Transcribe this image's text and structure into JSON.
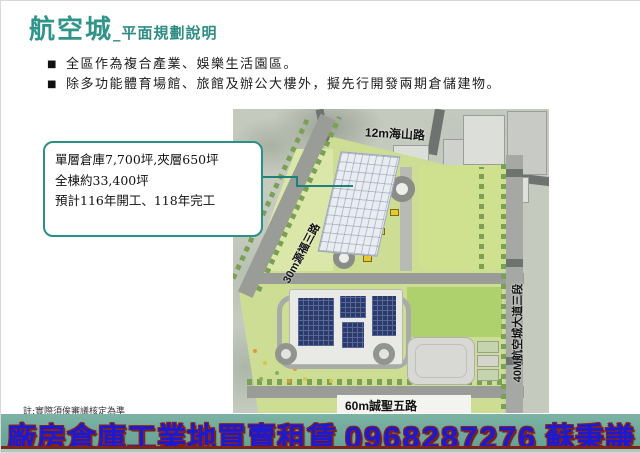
{
  "slide": {
    "title": {
      "main": "航空城",
      "sub": "_平面規劃說明"
    },
    "bullet_char": "■",
    "bullets": [
      "全區作為複合產業、娛樂生活園區。",
      "除多功能體育場館、旅館及辦公大樓外，擬先行開發兩期倉儲建物。"
    ],
    "callout": {
      "lines": [
        "單層倉庫7,700坪,夾層650坪",
        "全棟約33,400坪",
        "預計116年開工、118年完工"
      ]
    },
    "map_labels": {
      "road_top": "12m海山路",
      "road_left": "30m源福三路",
      "road_right": "40M航空城大道三段",
      "road_bottom": "60m誠聖五路"
    },
    "note": "註:實際須俟審議核定為準",
    "banner": {
      "label": "廠房倉庫工業地買賣租賃",
      "phone": "0968287276",
      "name": "蘇秉謙"
    },
    "colors": {
      "accent_teal": "#2f9589",
      "callout_border": "#2a9187",
      "banner_bg": "#63a092",
      "banner_text": "#1a1ad2",
      "banner_outline": "#8c2015",
      "plan_green": "#cddd94",
      "solar_panel": "#2c3a68"
    }
  }
}
